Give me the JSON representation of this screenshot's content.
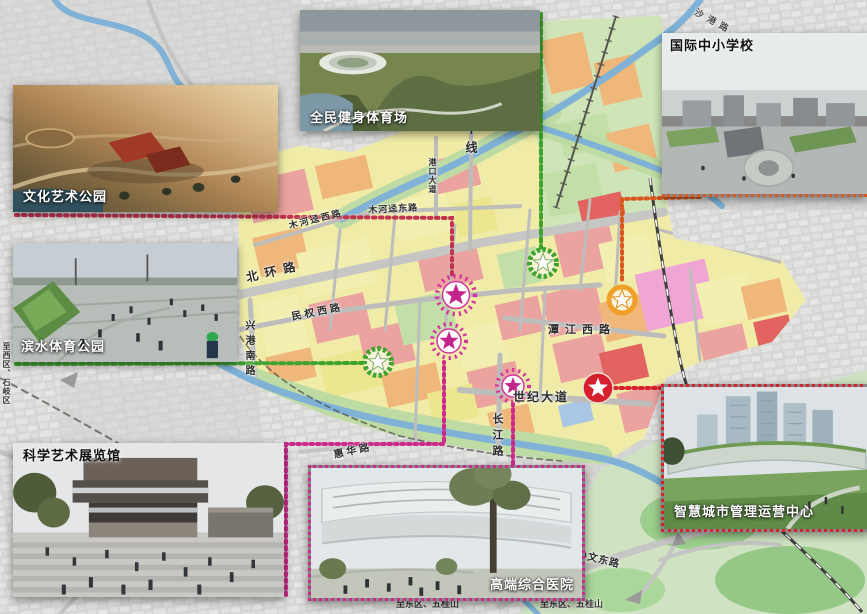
{
  "insets": {
    "stadium": {
      "label": "全民健身体育场"
    },
    "school": {
      "label": "国际中小学校"
    },
    "culture_park": {
      "label": "文化艺术公园"
    },
    "waterfront_park": {
      "label": "滨水体育公园"
    },
    "exhibition_hall": {
      "label": "科学艺术展览馆"
    },
    "hospital": {
      "label": "高端综合医院"
    },
    "smart_city_center": {
      "label": "智慧城市管理运营中心"
    }
  },
  "map": {
    "road_labels": {
      "north_ring": "北环路",
      "muhejing_west": "木河迳西路",
      "muhejing_east": "木河迳东路",
      "minquan_west": "民权西路",
      "xinggang_south": "兴港南路",
      "gangkou_avenue": "港口大道",
      "central_line": "中线",
      "tanjiang_west": "潭江西路",
      "century_avenue": "世纪大道",
      "changjiang": "长江路",
      "huihua": "惠华路",
      "sunwen_east": "孙文东路",
      "shagang": "沙港路",
      "to_west": "至西区、石岐区",
      "to_east_1": "至东区、五桂山",
      "to_east_2": "至东区、五桂山"
    },
    "markers": [
      {
        "id": "green-node-north",
        "style": "green-ring-star",
        "color": "#3fa32e"
      },
      {
        "id": "green-node-west",
        "style": "green-ring-star",
        "color": "#3fa32e"
      },
      {
        "id": "pink-node-1",
        "style": "dotted-ring-star",
        "color": "#d4359c"
      },
      {
        "id": "pink-node-2",
        "style": "dotted-ring-star",
        "color": "#d4359c"
      },
      {
        "id": "pink-node-3",
        "style": "dotted-ring-star",
        "color": "#d4359c"
      },
      {
        "id": "orange-node",
        "style": "orange-ring-star",
        "color": "#f0a028"
      },
      {
        "id": "red-node",
        "style": "red-badge-star",
        "color": "#d6202e"
      }
    ],
    "zone_colors": {
      "residential": "#eba3a0",
      "mixed_use": "#efb779",
      "public": "#f0eca8",
      "green_space": "#c3dfa8",
      "special": "#efa6d4",
      "core": "#e2635f",
      "facility": "#a9c7e4",
      "water": "#7fb2d6"
    },
    "connector_colors": {
      "culture": "#c23350",
      "stadium": "#3fa32e",
      "waterfront": "#3fa32e",
      "school": "#d8581f",
      "exhibition": "#cc2a8a",
      "hospital": "#cc2a8a",
      "smart": "#d6202e"
    }
  }
}
